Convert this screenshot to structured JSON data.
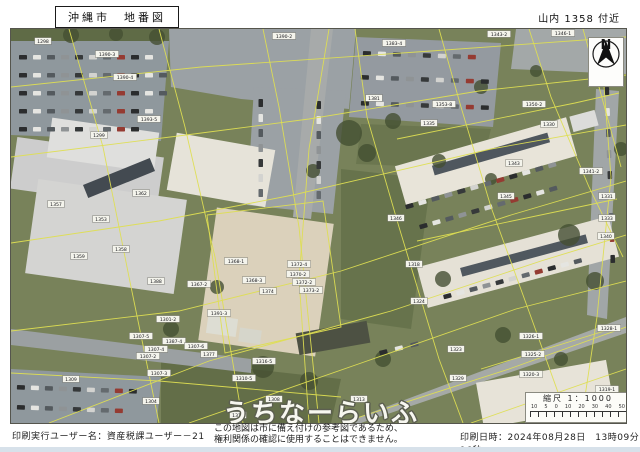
{
  "header": {
    "title": "沖縄市　地番図",
    "location": "山内 1358 付近"
  },
  "footer": {
    "user_label": "印刷実行ユーザー名：資産税課ユーザー－21",
    "notice_line1": "この地図は市に備え付けの参考図であるため、",
    "notice_line2": "権利関係の確認に使用することはできません。",
    "printed_label": "印刷日時：2024年08月28日　13時09分16秒"
  },
  "map": {
    "watermark": "うちなーらいふ",
    "compass": {
      "label": "N"
    },
    "scalebar": {
      "title": "縮尺 1：1000",
      "ticks": [
        "10",
        "5",
        "0",
        "10",
        "20",
        "30",
        "40",
        "50"
      ]
    },
    "palette": {
      "boundary": "#dede52",
      "tree": "#3d4a30",
      "photo_tint": "#b8a86a",
      "cars": [
        "#23262b",
        "#e8e9e9",
        "#4e555e",
        "#8d9298",
        "#2e3238",
        "#d5d6d7",
        "#5f666f",
        "#93352f"
      ]
    },
    "patches": [
      {
        "fill": "#74805a",
        "pts": "0,0 615,0 615,394 0,394"
      },
      {
        "fill": "#5a6844",
        "pts": "0,0 160,0 160,12 0,12"
      },
      {
        "fill": "#62704b",
        "pts": "330,140 420,150 400,300 330,290"
      },
      {
        "fill": "#5e6b47",
        "pts": "150,330 330,350 320,394 150,394"
      },
      {
        "fill": "#66734e",
        "pts": "350,95 480,100 470,140 345,135"
      },
      {
        "fill": "#8d97a1",
        "pts": "0,12 158,12 150,112 0,106"
      },
      {
        "fill": "#99a1a9",
        "pts": "158,0 345,0 338,80 230,70 160,58"
      },
      {
        "fill": "#929aa4",
        "pts": "345,8 490,14 482,98 338,88"
      },
      {
        "fill": "#a2a8ad",
        "pts": "505,0 615,0 615,45 500,40"
      },
      {
        "fill": "#99a1a9",
        "pts": "243,58 335,62 322,185 236,176"
      },
      {
        "fill": "#a6abaf",
        "pts": "300,0 322,0 300,190 282,188"
      },
      {
        "fill": "#8d97a1",
        "pts": "0,340 150,348 146,394 0,394"
      },
      {
        "fill": "#9aa0a6",
        "pts": "0,300 240,330 240,344 0,316"
      },
      {
        "fill": "#a4a9ab",
        "pts": "332,394 615,288 615,304 350,394"
      },
      {
        "fill": "#a0a6ac",
        "pts": "585,60 608,62 596,290 576,286"
      }
    ],
    "buildings": [
      {
        "x": 2,
        "y": 118,
        "w": 148,
        "h": 52,
        "r": 8,
        "fill": "#cfd0d4"
      },
      {
        "x": 38,
        "y": 96,
        "w": 108,
        "h": 40,
        "r": 8,
        "fill": "#e2e3e5"
      },
      {
        "x": 20,
        "y": 160,
        "w": 150,
        "h": 95,
        "r": 8,
        "fill": "#d6d7d9"
      },
      {
        "x": 72,
        "y": 142,
        "w": 72,
        "h": 14,
        "r": -22,
        "fill": "#3c4450"
      },
      {
        "x": 160,
        "y": 112,
        "w": 100,
        "h": 58,
        "r": 10,
        "fill": "#e9e7e1"
      },
      {
        "x": 196,
        "y": 186,
        "w": 118,
        "h": 134,
        "r": 8,
        "fill": "#ded4c1"
      },
      {
        "x": 386,
        "y": 112,
        "w": 178,
        "h": 40,
        "r": -16,
        "fill": "#ebe8e1"
      },
      {
        "x": 420,
        "y": 120,
        "w": 120,
        "h": 10,
        "r": -16,
        "fill": "#49525e"
      },
      {
        "x": 408,
        "y": 212,
        "w": 198,
        "h": 42,
        "r": -15,
        "fill": "#e8e5de"
      },
      {
        "x": 448,
        "y": 222,
        "w": 130,
        "h": 9,
        "r": -15,
        "fill": "#4a535f"
      },
      {
        "x": 468,
        "y": 342,
        "w": 132,
        "h": 46,
        "r": -10,
        "fill": "#eae7e0"
      },
      {
        "x": 286,
        "y": 298,
        "w": 72,
        "h": 22,
        "r": -10,
        "fill": "#474c41"
      },
      {
        "x": 196,
        "y": 288,
        "w": 30,
        "h": 18,
        "r": 8,
        "fill": "#e0e1da"
      },
      {
        "x": 228,
        "y": 300,
        "w": 22,
        "h": 14,
        "r": 8,
        "fill": "#d8d9d2"
      },
      {
        "x": 560,
        "y": 84,
        "w": 26,
        "h": 16,
        "r": -15,
        "fill": "#dfe0e2"
      }
    ],
    "trees": [
      [
        60,
        6,
        8
      ],
      [
        105,
        5,
        7
      ],
      [
        146,
        8,
        8
      ],
      [
        338,
        104,
        13
      ],
      [
        356,
        124,
        9
      ],
      [
        302,
        142,
        7
      ],
      [
        382,
        92,
        8
      ],
      [
        428,
        132,
        7
      ],
      [
        470,
        58,
        7
      ],
      [
        525,
        42,
        6
      ],
      [
        558,
        206,
        11
      ],
      [
        584,
        252,
        9
      ],
      [
        432,
        250,
        8
      ],
      [
        492,
        306,
        8
      ],
      [
        252,
        338,
        11
      ],
      [
        298,
        352,
        9
      ],
      [
        206,
        258,
        7
      ],
      [
        160,
        300,
        8
      ],
      [
        372,
        330,
        8
      ],
      [
        550,
        330,
        7
      ],
      [
        480,
        150,
        6
      ],
      [
        610,
        120,
        7
      ]
    ],
    "lines": [
      "0,58 190,38 420,22 615,8",
      "0,128 175,106 298,90 468,62 615,46",
      "0,214 148,192 282,166 480,120 615,96",
      "0,302 168,282 330,242 500,186 615,152",
      "38,394 198,332 380,282 530,232 615,206",
      "178,394 356,332 505,280 615,252",
      "330,394 498,340 615,298",
      "460,394 580,352 615,340",
      "58,0 92,118 118,248 148,394",
      "148,0 174,98 204,228 232,394",
      "252,0 268,78 288,198 308,394",
      "318,0 298,120 288,250 298,394",
      "344,0 356,88 388,198 428,330 452,394",
      "428,0 450,78 480,178 520,288 558,394",
      "518,0 540,68 578,158 612,228",
      "572,0 588,58 610,138",
      "590,18 600,148 586,288 570,394",
      "196,186 312,172 330,298 214,324 196,186",
      "0,344 148,352 240,360 330,368",
      "386,110 564,74 608,64",
      "406,212 606,170",
      "470,340 600,300"
    ],
    "car_rows": [
      {
        "x": 8,
        "y": 26,
        "r": 0,
        "n": 10,
        "g": 14
      },
      {
        "x": 8,
        "y": 44,
        "r": 0,
        "n": 11,
        "g": 14
      },
      {
        "x": 8,
        "y": 62,
        "r": 0,
        "n": 11,
        "g": 14
      },
      {
        "x": 8,
        "y": 80,
        "r": 0,
        "n": 10,
        "g": 14
      },
      {
        "x": 8,
        "y": 98,
        "r": 0,
        "n": 9,
        "g": 14
      },
      {
        "x": 352,
        "y": 22,
        "r": 2,
        "n": 8,
        "g": 15
      },
      {
        "x": 350,
        "y": 46,
        "r": 2,
        "n": 9,
        "g": 15
      },
      {
        "x": 350,
        "y": 72,
        "r": 2,
        "n": 9,
        "g": 15
      },
      {
        "x": 252,
        "y": 70,
        "r": 90,
        "n": 7,
        "g": 15
      },
      {
        "x": 310,
        "y": 72,
        "r": 90,
        "n": 7,
        "g": 15
      },
      {
        "x": 394,
        "y": 176,
        "r": -16,
        "n": 12,
        "g": 13.5
      },
      {
        "x": 408,
        "y": 196,
        "r": -16,
        "n": 11,
        "g": 13.5
      },
      {
        "x": 432,
        "y": 266,
        "r": -15,
        "n": 11,
        "g": 13.5
      },
      {
        "x": 598,
        "y": 58,
        "r": 88,
        "n": 9,
        "g": 21
      },
      {
        "x": 6,
        "y": 356,
        "r": 2,
        "n": 9,
        "g": 14
      },
      {
        "x": 6,
        "y": 376,
        "r": 2,
        "n": 8,
        "g": 14
      },
      {
        "x": 368,
        "y": 322,
        "r": -14,
        "n": 3,
        "g": 16
      }
    ],
    "labels": [
      {
        "t": "1390-2",
        "x": 273,
        "y": 7
      },
      {
        "t": "1298",
        "x": 32,
        "y": 12
      },
      {
        "t": "1390-3",
        "x": 96,
        "y": 25
      },
      {
        "t": "1390-4",
        "x": 114,
        "y": 48
      },
      {
        "t": "1393-5",
        "x": 138,
        "y": 90
      },
      {
        "t": "1299",
        "x": 88,
        "y": 106
      },
      {
        "t": "1383-4",
        "x": 383,
        "y": 14
      },
      {
        "t": "1381",
        "x": 363,
        "y": 69
      },
      {
        "t": "1343-2",
        "x": 488,
        "y": 5
      },
      {
        "t": "1346-1",
        "x": 552,
        "y": 4
      },
      {
        "t": "1353-8",
        "x": 433,
        "y": 75
      },
      {
        "t": "1350-2",
        "x": 523,
        "y": 75
      },
      {
        "t": "1335",
        "x": 418,
        "y": 94
      },
      {
        "t": "1330",
        "x": 538,
        "y": 95
      },
      {
        "t": "1362",
        "x": 130,
        "y": 164
      },
      {
        "t": "1357",
        "x": 45,
        "y": 175
      },
      {
        "t": "1353",
        "x": 90,
        "y": 190
      },
      {
        "t": "1358",
        "x": 110,
        "y": 220
      },
      {
        "t": "1359",
        "x": 68,
        "y": 227
      },
      {
        "t": "1388",
        "x": 145,
        "y": 252
      },
      {
        "t": "1343",
        "x": 503,
        "y": 134
      },
      {
        "t": "1341-2",
        "x": 580,
        "y": 142
      },
      {
        "t": "1345",
        "x": 495,
        "y": 167
      },
      {
        "t": "1346",
        "x": 385,
        "y": 189
      },
      {
        "t": "1331",
        "x": 596,
        "y": 167
      },
      {
        "t": "1333",
        "x": 596,
        "y": 189
      },
      {
        "t": "1340",
        "x": 595,
        "y": 207
      },
      {
        "t": "1368-1",
        "x": 225,
        "y": 232
      },
      {
        "t": "1368-3",
        "x": 243,
        "y": 251
      },
      {
        "t": "1374",
        "x": 257,
        "y": 262
      },
      {
        "t": "1372-4",
        "x": 288,
        "y": 235
      },
      {
        "t": "1370-2",
        "x": 287,
        "y": 245
      },
      {
        "t": "1372-2",
        "x": 293,
        "y": 253
      },
      {
        "t": "1373-2",
        "x": 300,
        "y": 261
      },
      {
        "t": "1367-2",
        "x": 188,
        "y": 255
      },
      {
        "t": "1301-2",
        "x": 157,
        "y": 290
      },
      {
        "t": "1391-3",
        "x": 208,
        "y": 284
      },
      {
        "t": "1318",
        "x": 403,
        "y": 235
      },
      {
        "t": "1324",
        "x": 408,
        "y": 272
      },
      {
        "t": "1387-4",
        "x": 163,
        "y": 312
      },
      {
        "t": "1307-6",
        "x": 185,
        "y": 317
      },
      {
        "t": "1307-5",
        "x": 130,
        "y": 307
      },
      {
        "t": "1307-4",
        "x": 145,
        "y": 320
      },
      {
        "t": "1307-2",
        "x": 137,
        "y": 327
      },
      {
        "t": "1377",
        "x": 198,
        "y": 325
      },
      {
        "t": "1307-3",
        "x": 148,
        "y": 344
      },
      {
        "t": "1304",
        "x": 140,
        "y": 372
      },
      {
        "t": "1309",
        "x": 60,
        "y": 350
      },
      {
        "t": "1316-5",
        "x": 253,
        "y": 332
      },
      {
        "t": "1310-5",
        "x": 233,
        "y": 349
      },
      {
        "t": "1308",
        "x": 263,
        "y": 370
      },
      {
        "t": "1313",
        "x": 348,
        "y": 370
      },
      {
        "t": "1316",
        "x": 227,
        "y": 386
      },
      {
        "t": "1323",
        "x": 445,
        "y": 320
      },
      {
        "t": "1329",
        "x": 447,
        "y": 349
      },
      {
        "t": "1326-1",
        "x": 520,
        "y": 307
      },
      {
        "t": "1325-2",
        "x": 522,
        "y": 325
      },
      {
        "t": "1320-3",
        "x": 520,
        "y": 345
      },
      {
        "t": "1328-1",
        "x": 598,
        "y": 299
      },
      {
        "t": "1319-1",
        "x": 596,
        "y": 360
      }
    ]
  }
}
